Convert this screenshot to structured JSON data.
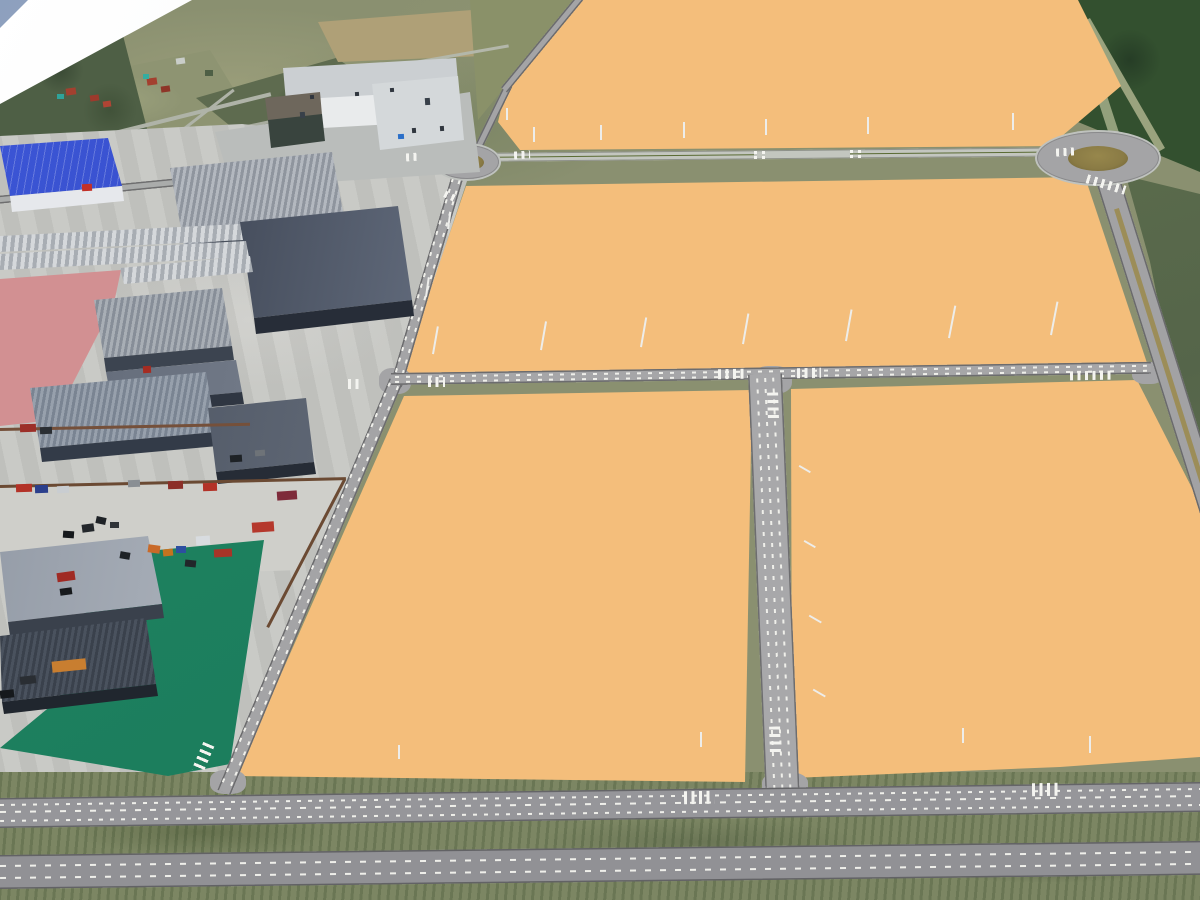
{
  "legend": "object item arrays are [x, y, width, height, color, rotateDeg, kind]; kind defaults to solid",
  "colors": {
    "orange": "#F4BE7B",
    "road": "#A4A4A6",
    "concrete": "#C6C7C3",
    "grass": "#7C8663",
    "aerial": "#8A9070",
    "woods": "#33502F",
    "woodsMid": "#4E5F45",
    "tan": "#AFA077",
    "green": "#1B7B5B",
    "pink": "#D29092",
    "sky": "#8DA0BE",
    "blue1": "#3D57D8",
    "blue2": "#2336A6",
    "lane": "#EFEFEA",
    "medGreen": "#5A6B33",
    "medTan": "#9C8D58",
    "island": "#8A7B45",
    "apron": "#BABDBB",
    "officeRoof": "#CBCFD2",
    "officeWall": "#E9EBEC",
    "annexRoof": "#6E675C",
    "wallDark": "#2A303C",
    "whDark": "#39404E",
    "whDarkHi": "#707A8C",
    "fence": "#6B4A33",
    "red": "#C23028"
  },
  "objects": {
    "aerial": [
      [
        -5,
        126,
        280,
        4,
        "#AFB3A8",
        -14
      ],
      [
        55,
        150,
        200,
        3,
        "#AFB3A8",
        -38
      ],
      [
        150,
        118,
        260,
        3,
        "#A8AC9F",
        -12
      ],
      [
        330,
        60,
        180,
        3,
        "#B3B7AA",
        -10
      ],
      [
        1090,
        -5,
        10,
        160,
        "#93A07C",
        -18
      ],
      [
        1120,
        10,
        8,
        150,
        "#9AA37E",
        -30
      ],
      [
        1150,
        210,
        6,
        280,
        "#8C9876",
        -17
      ],
      [
        66,
        88,
        10,
        7,
        "#A3402F",
        -8
      ],
      [
        90,
        95,
        9,
        6,
        "#9C3A2C",
        -8
      ],
      [
        103,
        101,
        8,
        6,
        "#B04434",
        -8
      ],
      [
        147,
        78,
        10,
        7,
        "#A3402F",
        -8
      ],
      [
        161,
        86,
        9,
        6,
        "#8E3528",
        -8
      ],
      [
        57,
        94,
        7,
        5,
        "#2FA39A",
        0
      ],
      [
        143,
        74,
        6,
        5,
        "#35ADA0",
        0
      ],
      [
        176,
        58,
        9,
        6,
        "#C9CDC9",
        -8
      ],
      [
        205,
        70,
        8,
        6,
        "#4E5F45",
        0
      ]
    ],
    "containers": [
      [
        16,
        484,
        16,
        8,
        "#B33227",
        -2
      ],
      [
        35,
        485,
        13,
        8,
        "#2B3F8C",
        -2
      ],
      [
        57,
        486,
        12,
        7,
        "#C9CDD1",
        -2
      ],
      [
        128,
        480,
        12,
        7,
        "#8A8F94",
        -2
      ],
      [
        168,
        481,
        15,
        8,
        "#8C2F28",
        -2
      ],
      [
        203,
        483,
        14,
        8,
        "#B33227",
        -2
      ],
      [
        277,
        491,
        20,
        9,
        "#7E2B3A",
        -4
      ],
      [
        96,
        517,
        10,
        7,
        "#1E2226",
        12
      ],
      [
        82,
        524,
        12,
        8,
        "#23272B",
        -8
      ],
      [
        63,
        531,
        11,
        7,
        "#16191C",
        4
      ],
      [
        110,
        522,
        9,
        6,
        "#303438",
        0
      ],
      [
        252,
        522,
        22,
        10,
        "#B5382C",
        -4
      ],
      [
        196,
        536,
        14,
        9,
        "#D8DCE0",
        -4
      ],
      [
        148,
        545,
        12,
        8,
        "#C96A28",
        8
      ],
      [
        163,
        549,
        10,
        7,
        "#C4731F",
        -6
      ],
      [
        176,
        546,
        10,
        7,
        "#2D4FA0",
        0
      ],
      [
        214,
        549,
        18,
        8,
        "#A83428",
        -3
      ],
      [
        120,
        552,
        10,
        7,
        "#1E2226",
        10
      ],
      [
        20,
        424,
        16,
        8,
        "#9C2F28",
        -2
      ],
      [
        40,
        427,
        12,
        7,
        "#2A2E33",
        -2
      ],
      [
        230,
        455,
        12,
        7,
        "#1E2226",
        -4
      ],
      [
        255,
        450,
        10,
        6,
        "#6E7378",
        -4
      ],
      [
        52,
        660,
        34,
        11,
        "#C87E30",
        -6
      ],
      [
        20,
        676,
        16,
        8,
        "#2A2E33",
        -6
      ],
      [
        0,
        690,
        14,
        8,
        "#16191C",
        -6
      ],
      [
        57,
        572,
        18,
        9,
        "#A02A24",
        -8
      ],
      [
        60,
        588,
        12,
        7,
        "#16191C",
        -8
      ],
      [
        185,
        560,
        11,
        7,
        "#22262A",
        6
      ]
    ],
    "lamps": [
      [
        533,
        127,
        1.5,
        15,
        "",
        0,
        "lamp"
      ],
      [
        600,
        125,
        1.5,
        15,
        "",
        0,
        "lamp"
      ],
      [
        683,
        122,
        1.5,
        16,
        "",
        0,
        "lamp"
      ],
      [
        765,
        119,
        1.5,
        16,
        "",
        0,
        "lamp"
      ],
      [
        867,
        117,
        1.5,
        17,
        "",
        0,
        "lamp"
      ],
      [
        1012,
        113,
        1.5,
        17,
        "",
        0,
        "lamp"
      ],
      [
        506,
        108,
        1.5,
        12,
        "",
        0,
        "lamp"
      ],
      [
        432,
        326,
        1.5,
        28,
        "",
        10,
        "lamp"
      ],
      [
        540,
        321,
        1.5,
        29,
        "",
        10,
        "lamp"
      ],
      [
        640,
        317,
        1.5,
        30,
        "",
        10,
        "lamp"
      ],
      [
        742,
        313,
        1.5,
        31,
        "",
        10,
        "lamp"
      ],
      [
        845,
        309,
        1.5,
        32,
        "",
        10,
        "lamp"
      ],
      [
        948,
        305,
        1.5,
        33,
        "",
        11,
        "lamp"
      ],
      [
        1050,
        301,
        1.5,
        34,
        "",
        11,
        "lamp"
      ],
      [
        447,
        212,
        1.5,
        17,
        "",
        8,
        "lamp"
      ],
      [
        425,
        277,
        1.5,
        20,
        "",
        8,
        "lamp"
      ],
      [
        798,
        468,
        13,
        1.5,
        "",
        30,
        "lamp"
      ],
      [
        803,
        543,
        13,
        1.5,
        "",
        30,
        "lamp"
      ],
      [
        808,
        618,
        14,
        1.5,
        "",
        30,
        "lamp"
      ],
      [
        812,
        692,
        14,
        1.5,
        "",
        30,
        "lamp"
      ],
      [
        398,
        745,
        1.5,
        14,
        "",
        0,
        "lamp"
      ],
      [
        700,
        732,
        1.5,
        15,
        "",
        0,
        "lamp"
      ],
      [
        962,
        728,
        1.5,
        15,
        "",
        0,
        "lamp"
      ],
      [
        1089,
        736,
        1.5,
        17,
        "",
        0,
        "lamp"
      ]
    ],
    "crosswalks": [
      [
        406,
        153,
        14,
        8,
        "",
        -4,
        "zebra"
      ],
      [
        514,
        151,
        16,
        8,
        "",
        -4,
        "zebra"
      ],
      [
        444,
        193,
        13,
        7,
        "",
        25,
        "zebra"
      ],
      [
        1056,
        148,
        18,
        8,
        "",
        -4,
        "zebra"
      ],
      [
        1086,
        180,
        40,
        9,
        "",
        17,
        "zebra"
      ],
      [
        348,
        379,
        15,
        10,
        "",
        0,
        "zebra"
      ],
      [
        428,
        377,
        17,
        10,
        "",
        0,
        "zebra"
      ],
      [
        718,
        369,
        26,
        10,
        "",
        -1,
        "zebra"
      ],
      [
        797,
        368,
        24,
        10,
        "",
        -1,
        "zebra"
      ],
      [
        760,
        400,
        26,
        11,
        "",
        88,
        "zebra"
      ],
      [
        762,
        734,
        26,
        11,
        "",
        88,
        "zebra"
      ],
      [
        684,
        791,
        30,
        13,
        "",
        -1,
        "zebra"
      ],
      [
        1032,
        783,
        26,
        13,
        "",
        -1,
        "zebra"
      ],
      [
        188,
        752,
        30,
        12,
        "",
        113,
        "zebra"
      ],
      [
        1070,
        371,
        42,
        9,
        "",
        -1,
        "zebra"
      ]
    ],
    "dots": [
      [
        754,
        151,
        2.5,
        2.5,
        "",
        0,
        "dot"
      ],
      [
        762,
        151,
        2.5,
        2.5,
        "",
        0,
        "dot"
      ],
      [
        754,
        156,
        2.5,
        2.5,
        "",
        0,
        "dot"
      ],
      [
        762,
        156,
        2.5,
        2.5,
        "",
        0,
        "dot"
      ],
      [
        850,
        150,
        2.5,
        2.5,
        "",
        0,
        "dot"
      ],
      [
        858,
        150,
        2.5,
        2.5,
        "",
        0,
        "dot"
      ],
      [
        850,
        155,
        2.5,
        2.5,
        "",
        0,
        "dot"
      ],
      [
        858,
        155,
        2.5,
        2.5,
        "",
        0,
        "dot"
      ],
      [
        82,
        184,
        10,
        7,
        "#C23028",
        -3
      ],
      [
        398,
        134,
        6,
        5,
        "#2B6FC8",
        -3
      ],
      [
        143,
        366,
        8,
        7,
        "#A52C22",
        -3
      ],
      [
        310,
        95,
        4,
        4,
        "#30363E",
        -4
      ],
      [
        355,
        92,
        4,
        4,
        "#30363E",
        -4
      ],
      [
        390,
        88,
        4,
        4,
        "#30363E",
        -4
      ],
      [
        425,
        98,
        5,
        7,
        "#384049",
        -4
      ],
      [
        300,
        112,
        5,
        6,
        "#384049",
        -4
      ],
      [
        412,
        128,
        4,
        5,
        "#30363E",
        -4
      ],
      [
        440,
        126,
        4,
        5,
        "#30363E",
        -4
      ]
    ]
  }
}
